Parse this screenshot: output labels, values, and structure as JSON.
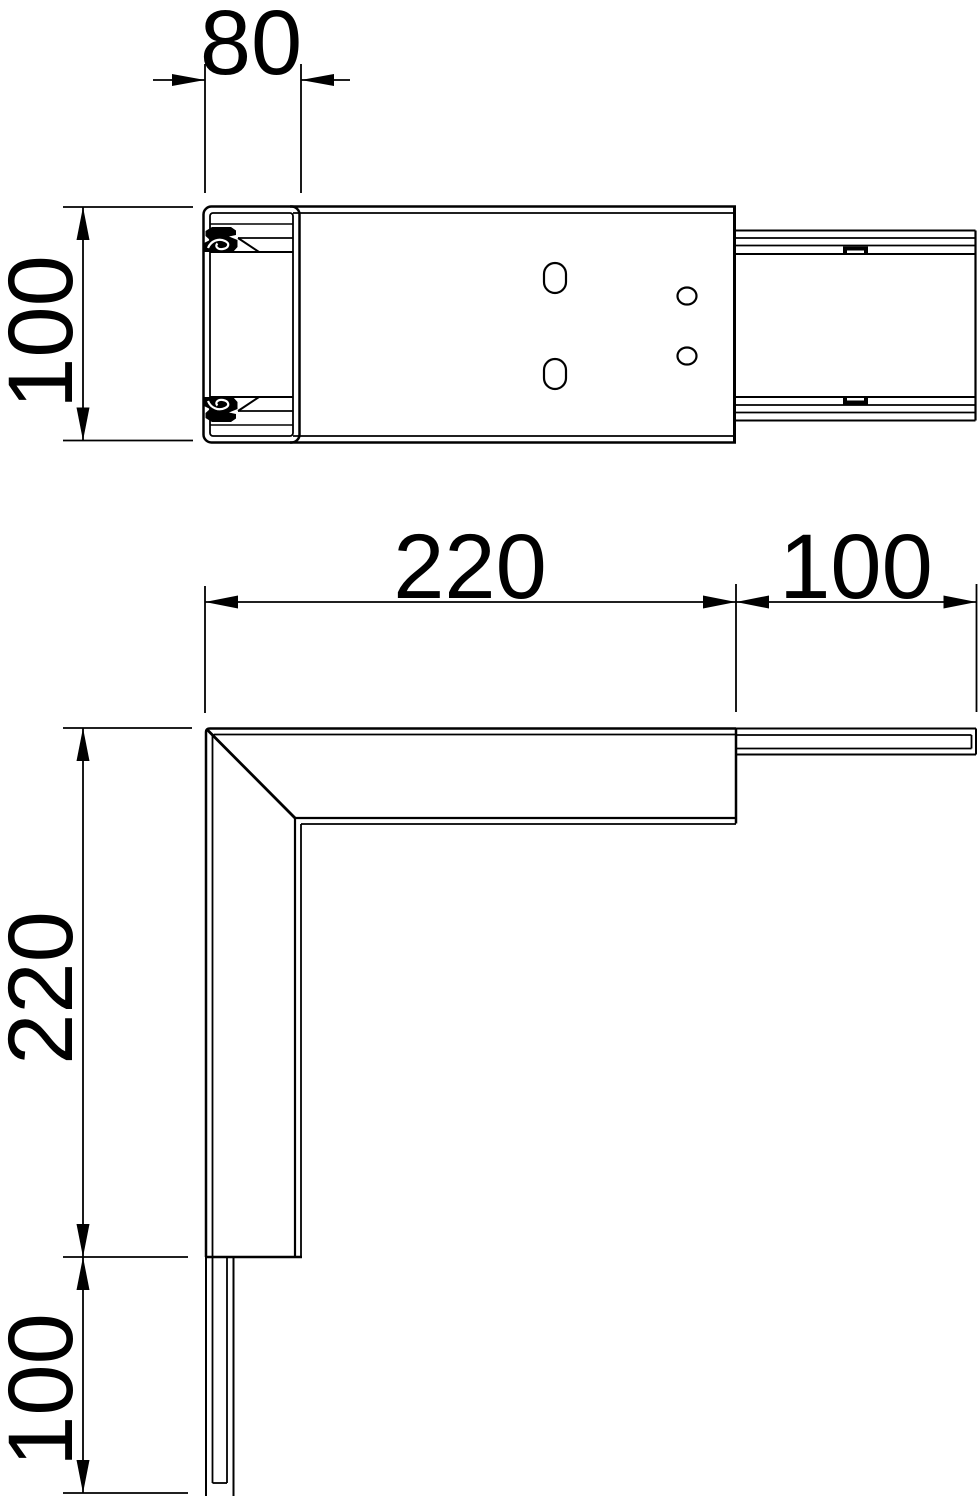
{
  "drawing": {
    "background": "#ffffff",
    "line_color": "#000000",
    "front_view": {
      "width": "80",
      "height": "100"
    },
    "plan_view": {
      "horizontal_leg": "220",
      "horizontal_duct": "100",
      "vertical_leg": "220",
      "vertical_duct": "100"
    }
  }
}
